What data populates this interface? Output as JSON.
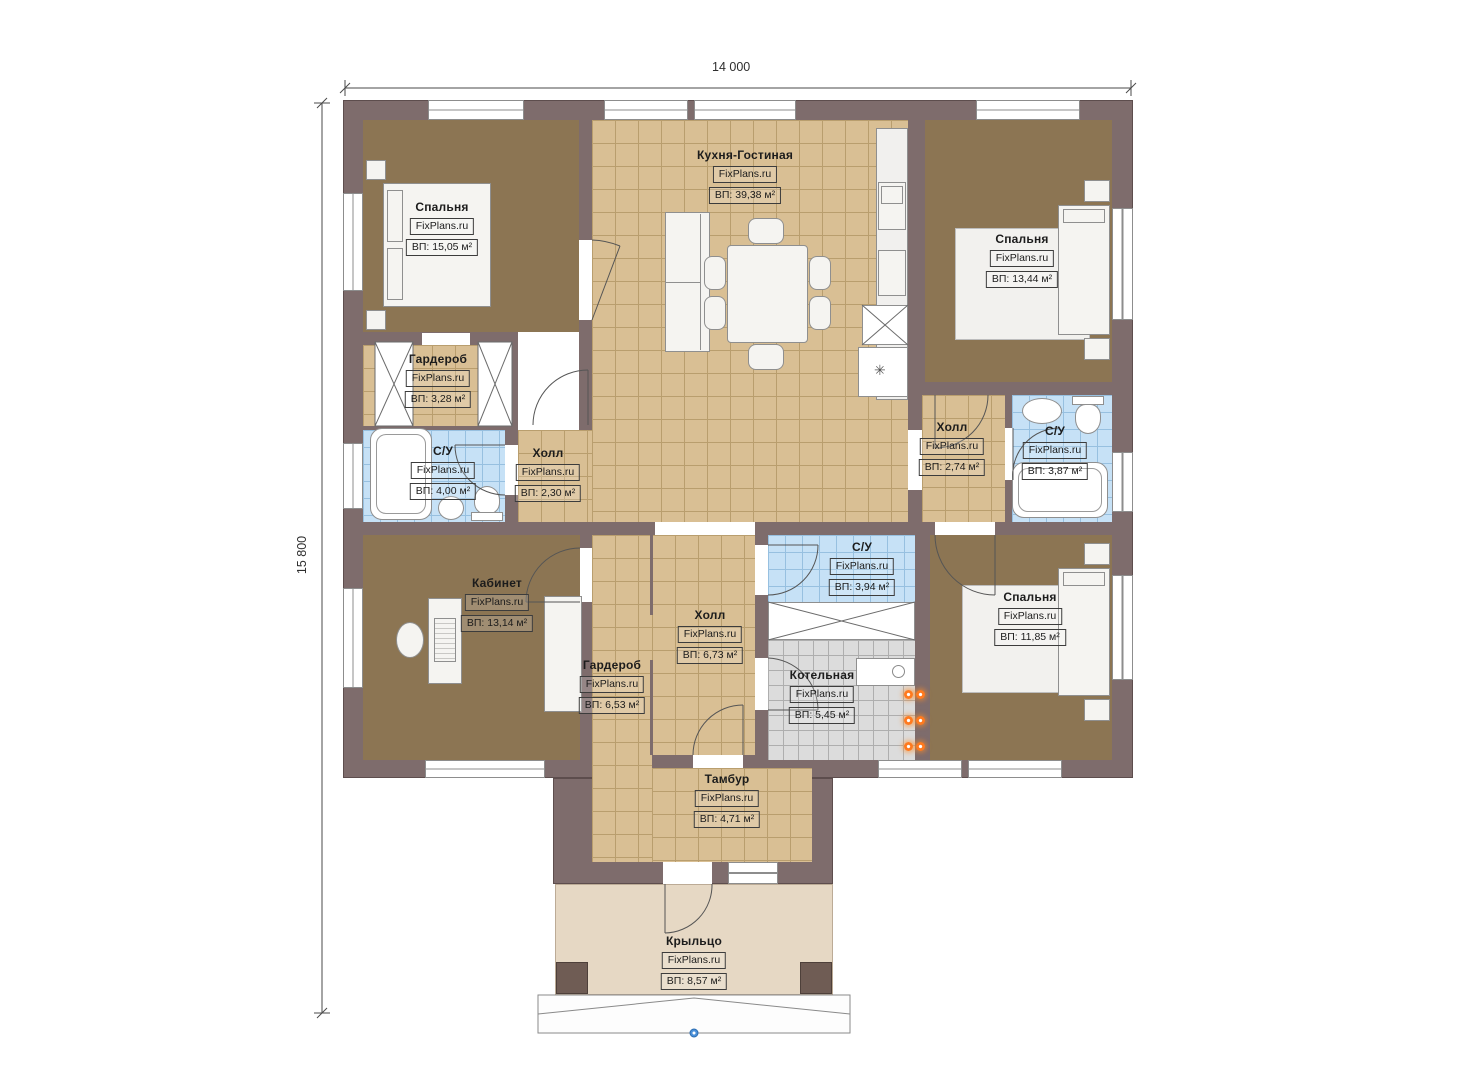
{
  "brand": "FixPlans.ru",
  "dims": {
    "width": "14 000",
    "height": "15 800"
  },
  "rooms": [
    {
      "name": "Спальня",
      "area": "ВП: 15,05 м²"
    },
    {
      "name": "Кухня-Гостиная",
      "area": "ВП: 39,38 м²"
    },
    {
      "name": "Спальня",
      "area": "ВП: 13,44 м²"
    },
    {
      "name": "Гардероб",
      "area": "ВП: 3,28 м²"
    },
    {
      "name": "С/У",
      "area": "ВП: 4,00 м²"
    },
    {
      "name": "Холл",
      "area": "ВП: 2,30 м²"
    },
    {
      "name": "Холл",
      "area": "ВП: 2,74 м²"
    },
    {
      "name": "С/У",
      "area": "ВП: 3,87 м²"
    },
    {
      "name": "Кабинет",
      "area": "ВП: 13,14 м²"
    },
    {
      "name": "Холл",
      "area": "ВП: 6,73 м²"
    },
    {
      "name": "С/У",
      "area": "ВП: 3,94 м²"
    },
    {
      "name": "Спальня",
      "area": "ВП: 11,85 м²"
    },
    {
      "name": "Гардероб",
      "area": "ВП: 6,53 м²"
    },
    {
      "name": "Котельная",
      "area": "ВП: 5,45 м²"
    },
    {
      "name": "Тамбур",
      "area": "ВП: 4,71 м²"
    },
    {
      "name": "Крыльцо",
      "area": "ВП: 8,57 м²"
    }
  ],
  "icons": {
    "sink_symbol": "✳"
  },
  "colors": {
    "wall": "#7e6c6c",
    "wood_floor": "#8c7553",
    "tile_floor": "#d9bf94",
    "bath_floor": "#c6e1f6",
    "boiler_floor": "#dcdcdc",
    "porch_floor": "#e6d8c4",
    "heat_dot": "#ff7a1f",
    "marker_blue": "#4a90d9"
  }
}
